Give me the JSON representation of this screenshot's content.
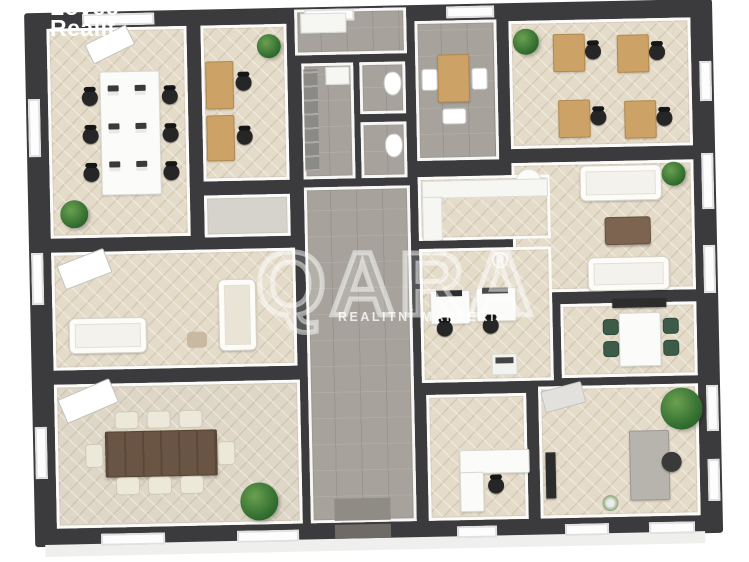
{
  "image": {
    "kind": "3D office floor plan rendering",
    "width": 749,
    "height": 562
  },
  "branding": {
    "logo_line1": "Lovec",
    "logo_line2": "Realit",
    "watermark_text": "QARA",
    "watermark_reg": "®",
    "watermark_subtext": "REALITNÍ MAKLÉŘI"
  },
  "palette": {
    "background": "#ffffff",
    "wall_dark": "#3b3b3d",
    "wall_face_white": "#ffffff",
    "floor_wood_herringbone": "#e4dbc9",
    "floor_tile_gray": "#a7a29b",
    "desk_wood": "#cda266",
    "table_dark_wood": "#6a5443",
    "chair_black": "#262626",
    "chair_green": "#3c5c49",
    "sofa_white": "#f4f2ec",
    "plant_green": "#2f6b2e",
    "watermark_white": "rgba(255,255,255,0.55)"
  },
  "floor_plan": {
    "rooms": [
      {
        "id": "open-office",
        "floor": "wood-herringbone",
        "contents": "long white worktable, 6 laptops, 6 black task chairs, white cabinet, plant"
      },
      {
        "id": "double-office",
        "floor": "wood-herringbone",
        "contents": "2 wooden desks, 2 black task chairs, plant"
      },
      {
        "id": "entry-hall",
        "floor": "gray-tile",
        "contents": "white bench"
      },
      {
        "id": "utility-room",
        "floor": "gray-tile",
        "contents": "gray shelving, washbasin"
      },
      {
        "id": "wc-1",
        "floor": "gray-tile",
        "contents": "toilet"
      },
      {
        "id": "wc-2",
        "floor": "gray-tile",
        "contents": "toilet"
      },
      {
        "id": "reception",
        "floor": "gray-tile",
        "contents": "wooden table, 2 white chairs, stool"
      },
      {
        "id": "quad-office",
        "floor": "wood-herringbone",
        "contents": "4 wooden desks, 4 black task chairs, plant"
      },
      {
        "id": "lounge",
        "floor": "wood-herringbone",
        "contents": "2 white sofas, brown coffee table, round side table, plant"
      },
      {
        "id": "small-meeting-room",
        "floor": "wood-herringbone",
        "contents": "white table, 4 green chairs, wall screen"
      },
      {
        "id": "kitchenette",
        "floor": "wood-herringbone",
        "contents": "white counters"
      },
      {
        "id": "monitor-office",
        "floor": "wood-herringbone",
        "contents": "2 white desks with monitors, 2 black task chairs, printer stand"
      },
      {
        "id": "sofa-room",
        "floor": "wood-herringbone",
        "contents": "cream sofa, beige sofa, pouf, angled white console"
      },
      {
        "id": "board-room",
        "floor": "wood-herringbone",
        "contents": "dark wood table, 8 cream chairs, angled white console, plant"
      },
      {
        "id": "corridor",
        "floor": "gray-tile",
        "contents": "doormat"
      },
      {
        "id": "corner-office",
        "floor": "wood-herringbone",
        "contents": "L-shaped white desk, black task chair"
      },
      {
        "id": "director-office",
        "floor": "wood-herringbone",
        "contents": "gray desk, dark chair, TV panel, sideboard, large plant, small flower pot"
      }
    ]
  }
}
